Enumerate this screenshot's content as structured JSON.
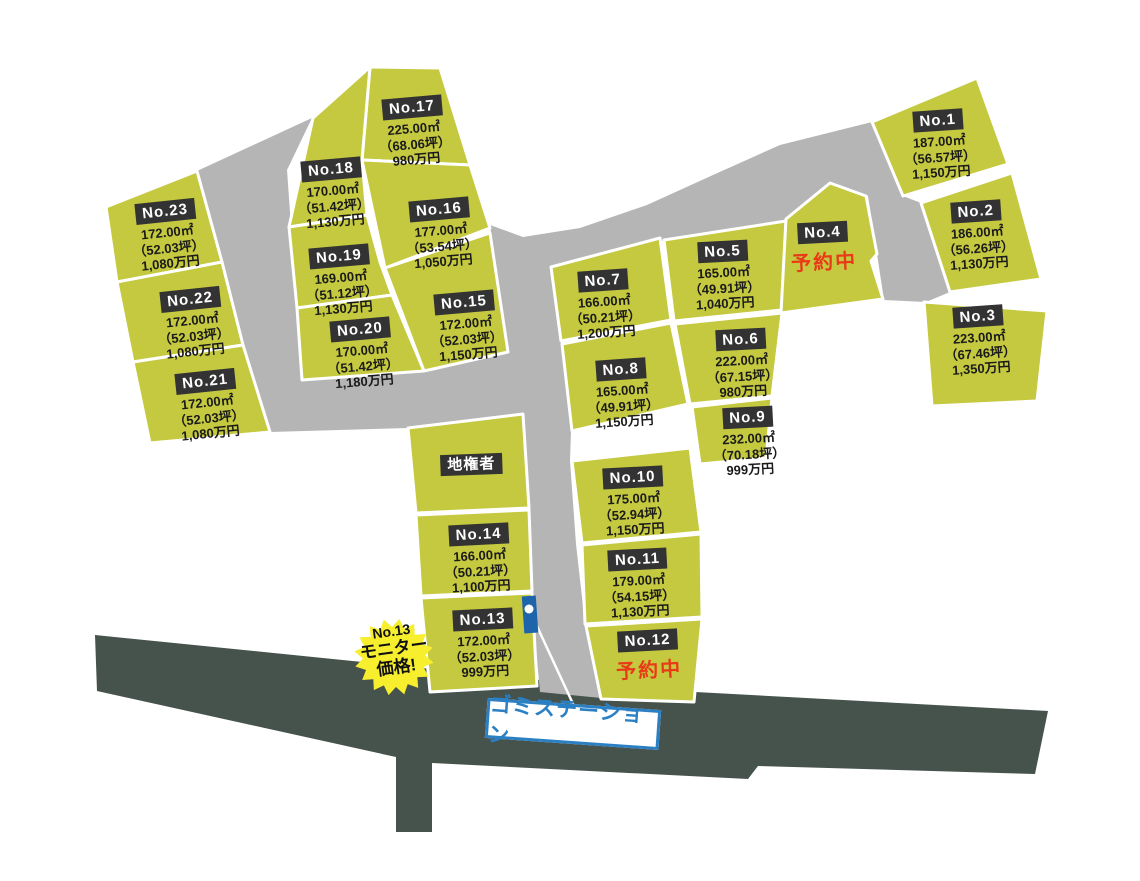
{
  "map": {
    "colors": {
      "plot": "#c5c93f",
      "road": "#b5b5b5",
      "front_road": "#46524c",
      "chip_bg": "#333333",
      "chip_text": "#ffffff",
      "detail_text": "#1a1a1a",
      "reserved_red": "#e83a17",
      "garbage_blue": "#2b7fc3",
      "marker_blue": "#1e64ab",
      "badge_yellow": "#f7ee2e"
    },
    "garbage_station": {
      "label": "ゴミステーション"
    },
    "monitor_badge": {
      "line1": "No.13",
      "line2": "モニター",
      "line3": "価格!"
    }
  },
  "plots": [
    {
      "id": "No.1",
      "area": "187.00㎡",
      "tsubo": "（56.57坪）",
      "price": "1,150万円"
    },
    {
      "id": "No.2",
      "area": "186.00㎡",
      "tsubo": "（56.26坪）",
      "price": "1,130万円"
    },
    {
      "id": "No.3",
      "area": "223.00㎡",
      "tsubo": "（67.46坪）",
      "price": "1,350万円"
    },
    {
      "id": "No.4",
      "status": "予約中"
    },
    {
      "id": "No.5",
      "area": "165.00㎡",
      "tsubo": "（49.91坪）",
      "price": "1,040万円"
    },
    {
      "id": "No.6",
      "area": "222.00㎡",
      "tsubo": "（67.15坪）",
      "price": "980万円"
    },
    {
      "id": "No.7",
      "area": "166.00㎡",
      "tsubo": "（50.21坪）",
      "price": "1,200万円"
    },
    {
      "id": "No.8",
      "area": "165.00㎡",
      "tsubo": "（49.91坪）",
      "price": "1,150万円"
    },
    {
      "id": "No.9",
      "area": "232.00㎡",
      "tsubo": "（70.18坪）",
      "price": "999万円"
    },
    {
      "id": "No.10",
      "area": "175.00㎡",
      "tsubo": "（52.94坪）",
      "price": "1,150万円"
    },
    {
      "id": "No.11",
      "area": "179.00㎡",
      "tsubo": "（54.15坪）",
      "price": "1,130万円"
    },
    {
      "id": "No.12",
      "status": "予約中"
    },
    {
      "id": "No.13",
      "area": "172.00㎡",
      "tsubo": "（52.03坪）",
      "price": "999万円"
    },
    {
      "id": "No.14",
      "area": "166.00㎡",
      "tsubo": "（50.21坪）",
      "price": "1,100万円"
    },
    {
      "id": "No.15",
      "area": "172.00㎡",
      "tsubo": "（52.03坪）",
      "price": "1,150万円"
    },
    {
      "id": "No.16",
      "area": "177.00㎡",
      "tsubo": "（53.54坪）",
      "price": "1,050万円"
    },
    {
      "id": "No.17",
      "area": "225.00㎡",
      "tsubo": "（68.06坪）",
      "price": "980万円"
    },
    {
      "id": "No.18",
      "area": "170.00㎡",
      "tsubo": "（51.42坪）",
      "price": "1,130万円"
    },
    {
      "id": "No.19",
      "area": "169.00㎡",
      "tsubo": "（51.12坪）",
      "price": "1,130万円"
    },
    {
      "id": "No.20",
      "area": "170.00㎡",
      "tsubo": "（51.42坪）",
      "price": "1,180万円"
    },
    {
      "id": "No.21",
      "area": "172.00㎡",
      "tsubo": "（52.03坪）",
      "price": "1,080万円"
    },
    {
      "id": "No.22",
      "area": "172.00㎡",
      "tsubo": "（52.03坪）",
      "price": "1,080万円"
    },
    {
      "id": "No.23",
      "area": "172.00㎡",
      "tsubo": "（52.03坪）",
      "price": "1,080万円"
    },
    {
      "id": "地権者"
    }
  ]
}
